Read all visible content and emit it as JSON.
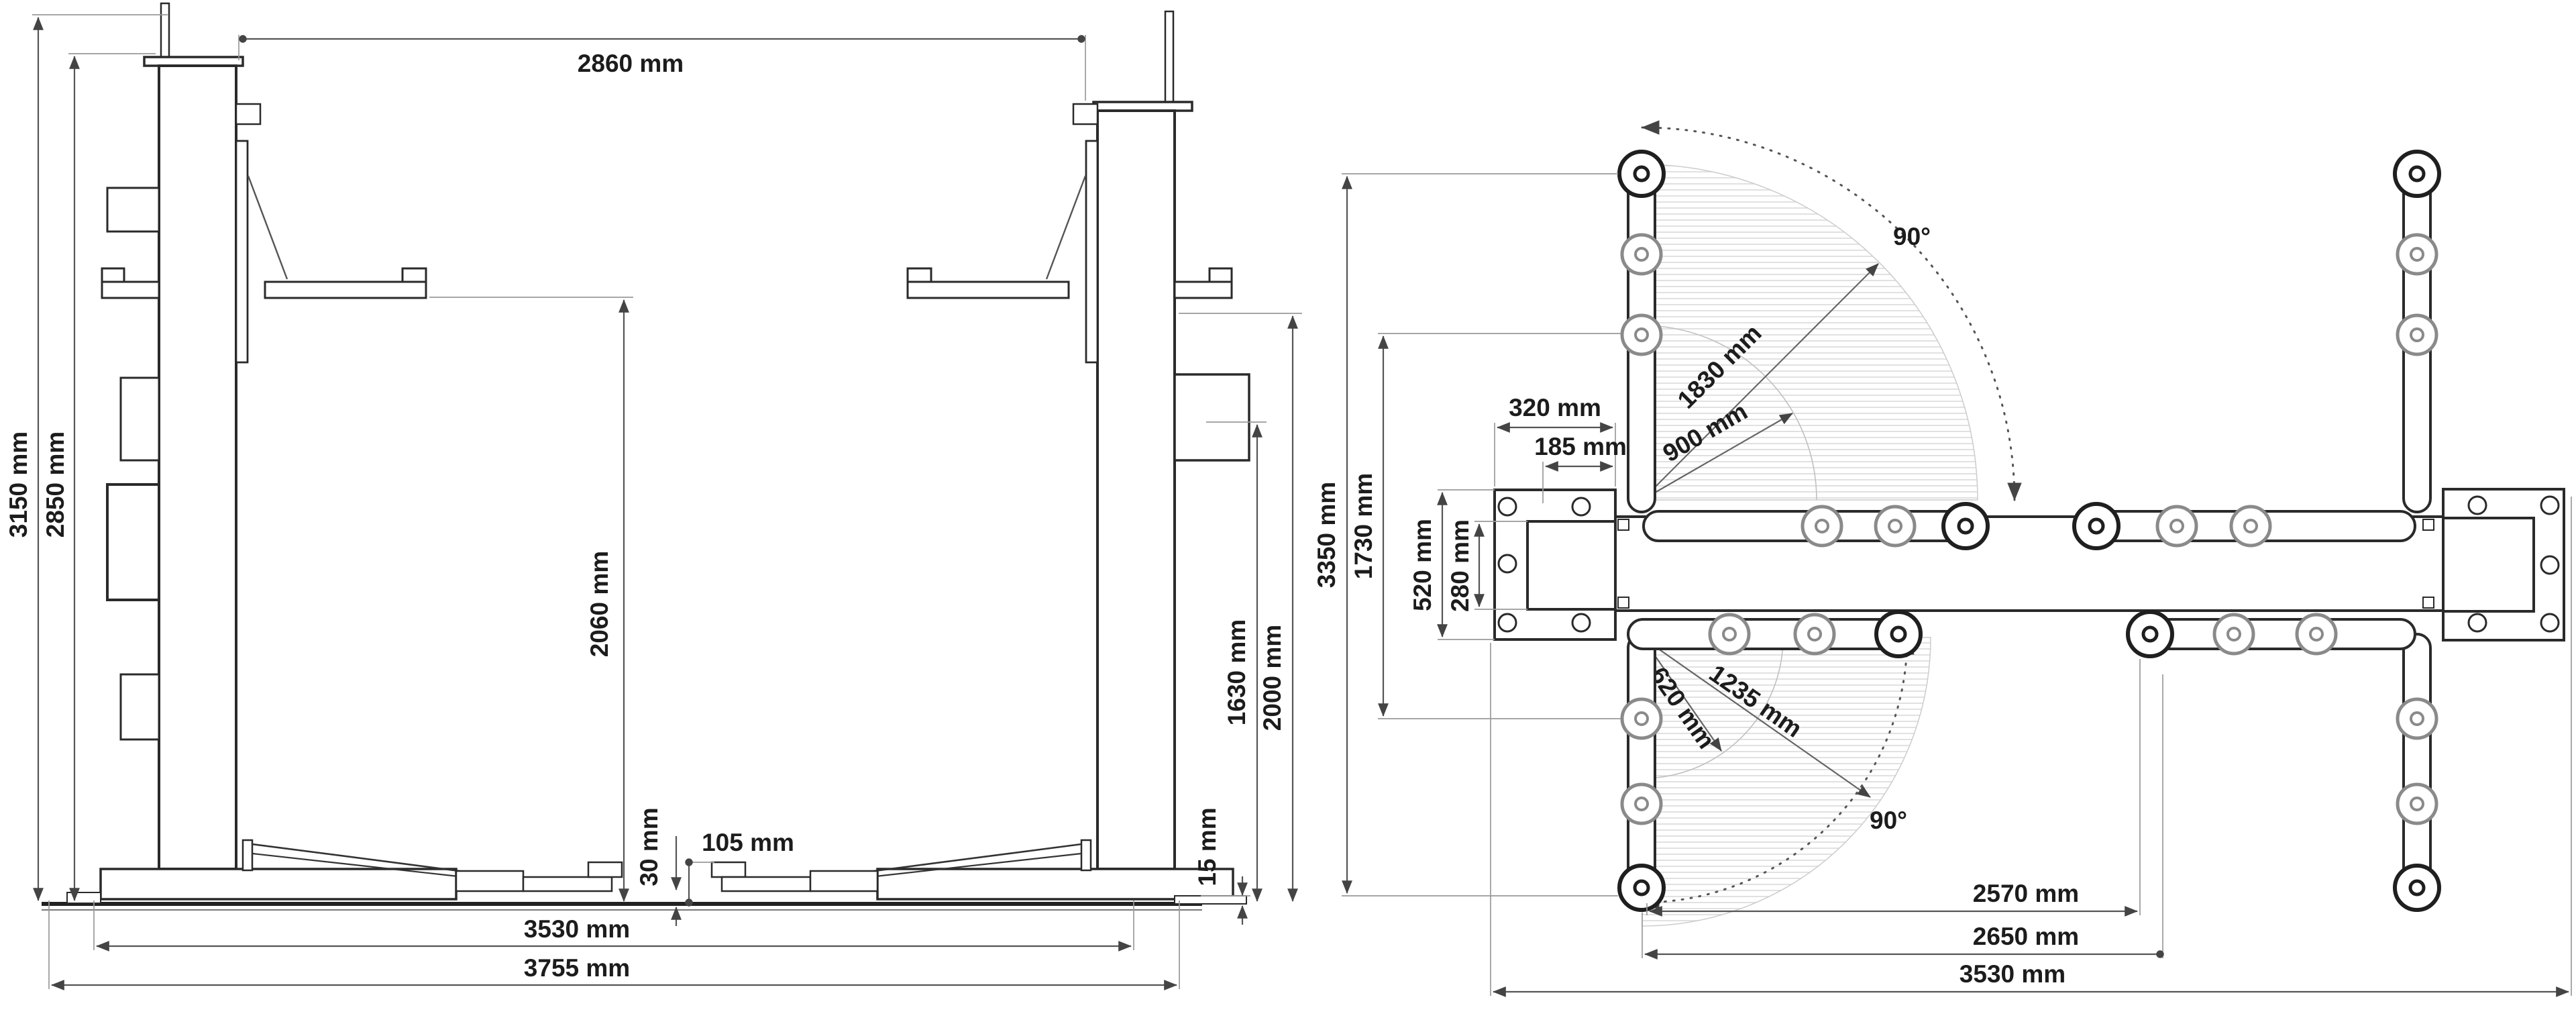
{
  "drawing": {
    "unit": "mm",
    "front_view": {
      "name": "two-post-lift-front-elevation",
      "dims": {
        "w2860": "2860 mm",
        "h3150": "3150 mm",
        "h2850": "2850 mm",
        "h2060": "2060 mm",
        "h1630": "1630 mm",
        "h2000": "2000 mm",
        "s30": "30 mm",
        "s105": "105 mm",
        "s15": "15 mm",
        "w3530": "3530 mm",
        "w3755": "3755 mm"
      }
    },
    "plan_view": {
      "name": "two-post-lift-plan-view",
      "dims": {
        "a90_top": "90°",
        "r1830": "1830 mm",
        "r900": "900 mm",
        "w320": "320 mm",
        "w185": "185 mm",
        "h3350": "3350 mm",
        "h1730": "1730 mm",
        "h520": "520 mm",
        "h280": "280 mm",
        "r620": "620 mm",
        "r1235": "1235 mm",
        "a90_bottom": "90°",
        "s2570": "2570 mm",
        "s2650": "2650 mm",
        "s3530": "3530 mm"
      }
    },
    "colors": {
      "outline": "#2a2a2a",
      "dimension_line": "#555555",
      "extension_line": "#9a9a9a",
      "hatch": "#dcdcdc",
      "text": "#1c1c1c"
    }
  }
}
